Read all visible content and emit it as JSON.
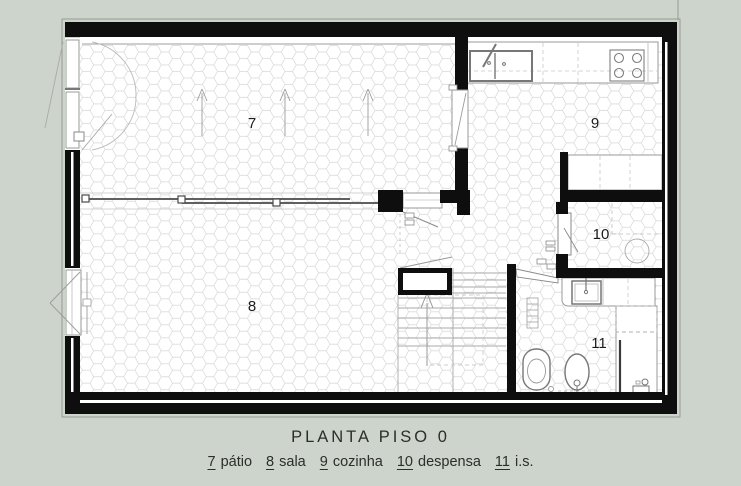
{
  "header": {
    "title": "PLANTA PISO 0"
  },
  "legend": {
    "items": [
      {
        "num": "7",
        "label": "pátio"
      },
      {
        "num": "8",
        "label": "sala"
      },
      {
        "num": "9",
        "label": "cozinha"
      },
      {
        "num": "10",
        "label": "despensa"
      },
      {
        "num": "11",
        "label": "i.s."
      }
    ]
  },
  "rooms": {
    "patio": {
      "number": "7",
      "name": "pátio"
    },
    "sala": {
      "number": "8",
      "name": "sala"
    },
    "cozinha": {
      "number": "9",
      "name": "cozinha"
    },
    "despensa": {
      "number": "10",
      "name": "despensa"
    },
    "is": {
      "number": "11",
      "name": "i.s."
    }
  },
  "colors": {
    "background": "#cdd4cb",
    "wall": "#0e0e0e",
    "floor": "#ffffff",
    "tile_line": "#d6d6d6",
    "fixture_line": "#7a7a7a",
    "light_line": "#aaaaaa",
    "text": "#2b2e2a"
  }
}
